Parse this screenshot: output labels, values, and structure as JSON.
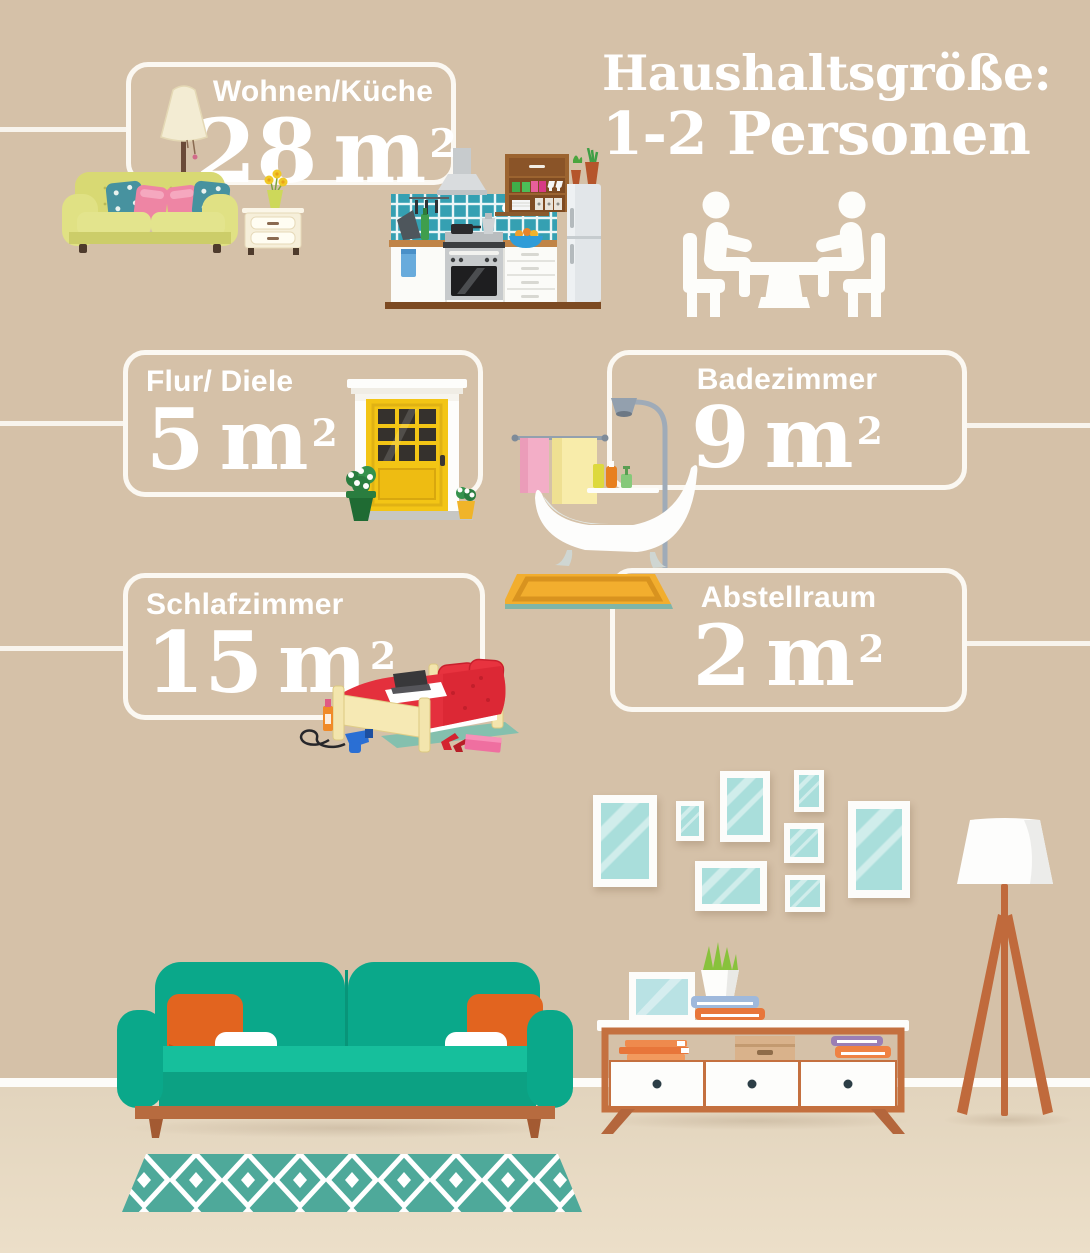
{
  "title": {
    "line1": "Haushaltsgröße:",
    "line2": "1-2 Personen"
  },
  "rooms": [
    {
      "id": "wohnen-kueche",
      "label": "Wohnen/Küche",
      "area": "28",
      "unit": "m",
      "exponent": "2"
    },
    {
      "id": "flur-diele",
      "label": "Flur/ Diele",
      "area": "5",
      "unit": "m",
      "exponent": "2"
    },
    {
      "id": "badezimmer",
      "label": "Badezimmer",
      "area": "9",
      "unit": "m",
      "exponent": "2"
    },
    {
      "id": "schlafzimmer",
      "label": "Schlafzimmer",
      "area": "15",
      "unit": "m",
      "exponent": "2"
    },
    {
      "id": "abstellraum",
      "label": "Abstellraum",
      "area": "2",
      "unit": "m",
      "exponent": "2"
    }
  ],
  "illustrations": {
    "household": "two-people-at-table-icon",
    "living": "sofa-floor-lamp-nightstand",
    "kitchen": "kitchen-unit-with-fridge",
    "hall": "yellow-front-door-with-plants",
    "bath": "clawfoot-bathtub-shower-towels",
    "bedroom": "double-bed-with-laptop",
    "decor": [
      "gallery-wall-frames",
      "teal-sofa-orange-pillows",
      "white-sideboard",
      "tripod-floor-lamp",
      "diamond-pattern-rug"
    ]
  },
  "palette": {
    "wall": "#d5c1a8",
    "floor_top": "#e2d4bd",
    "floor_bottom": "#ecdfc9",
    "outline_white": "#f8f4ed",
    "text_white": "#ffffff",
    "couch_teal": "#0aa88a",
    "pillow_orange": "#e2641f",
    "wood_orange": "#c06a3c",
    "rug_teal": "#4ea99a",
    "door_yellow": "#f3c515",
    "bed_red": "#e4303d",
    "bath_mat_yellow": "#f2ae2e",
    "frame_glass": "#a9dedb"
  }
}
